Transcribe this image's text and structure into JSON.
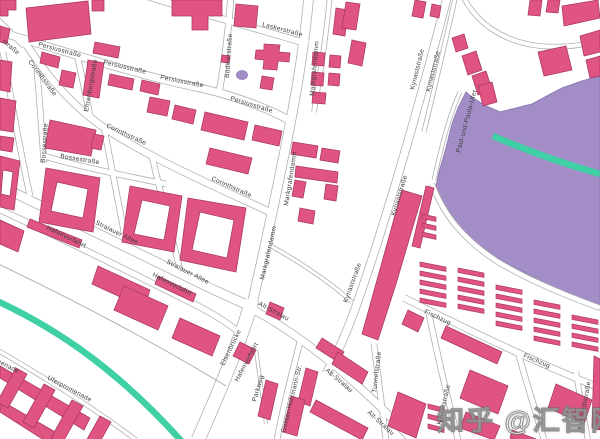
{
  "watermark": {
    "text": "知乎 @汇智网"
  },
  "map": {
    "colors": {
      "building_fill": "#df5480",
      "building_stroke": "#ad3a67",
      "water_fill": "#a38dc6",
      "water_stroke": "#8f7bb5",
      "road_casing": "#b2b0b0",
      "road_fill": "#ffffff",
      "rail_teal": "#3fd0a5",
      "label": "#3d3d3d",
      "background": "#ffffff"
    },
    "water": "600,76 582,81 562,88 545,97 532,104 516,108 500,112 484,105 472,97 466,92 458,108 452,124 446,148 439,172 436,186 443,208 456,227 473,243 494,257 518,269 544,283 570,295 590,305 600,310",
    "pond": {
      "cx": 242,
      "cy": 75,
      "rx": 5.5,
      "ry": 4.5
    },
    "teal_lines": [
      "M 493,136 C 530,152 565,164 600,174",
      "M -5,300 C 60,330 120,372 185,445"
    ],
    "roads": [
      {
        "n": "persiusstrasse",
        "d": "M -6,30 C 60,50 140,76 200,88 C 235,96 268,108 294,123",
        "w": 7
      },
      {
        "n": "corinthstrasse",
        "d": "M 22,38 C 40,66 62,96 96,122 C 140,154 212,185 274,214",
        "w": 6.5
      },
      {
        "n": "laskerstrasse",
        "d": "M 140,-6 L 205,14 C 240,24 275,34 308,44",
        "w": 6
      },
      {
        "n": "boedikerstrasse",
        "d": "M 231,-6 C 229,28 225,60 219,93",
        "w": 5.5
      },
      {
        "n": "markgrafendamm",
        "d": "M 309,-6 C 305,40 297,90 288,135 C 279,180 268,235 252,304",
        "w": 9
      },
      {
        "n": "kynaststrasse",
        "d": "M 448,-6 C 436,40 420,100 404,155 C 390,203 372,262 354,312 C 346,334 336,356 326,374",
        "w": 7.5
      },
      {
        "n": "kynaststrasse-parallel",
        "d": "M 456,-6 C 446,40 434,90 424,132",
        "w": 3.5
      },
      {
        "n": "rail-corridor",
        "d": "M 462,-6 C 476,24 504,42 540,46 C 565,48 585,45 600,40",
        "w": 4
      },
      {
        "n": "stralauer-allee",
        "d": "M -6,183 C 60,215 140,254 212,289 L 256,309",
        "w": 8.5
      },
      {
        "n": "hafenvorfahrt",
        "d": "M -6,207 C 55,235 130,272 192,303 C 212,313 228,323 240,333",
        "w": 5.5
      },
      {
        "n": "elsenbruecke",
        "d": "M 252,300 C 241,340 220,390 198,440",
        "w": 13
      },
      {
        "n": "alt-stralau",
        "d": "M 254,310 C 292,331 332,361 372,399 C 387,413 400,427 412,440",
        "w": 7
      },
      {
        "n": "fischzug",
        "d": "M 404,298 C 455,323 520,356 600,388",
        "w": 6
      },
      {
        "n": "paul-und-paula-ufer",
        "d": "M 460,92 C 449,116 441,148 434,180",
        "w": 3
      },
      {
        "n": "shore-street",
        "d": "M 432,184 C 444,216 464,240 498,262 C 534,283 570,297 600,308",
        "w": 4.5
      },
      {
        "n": "tunnelstrasse",
        "d": "M 374,344 C 378,375 382,408 386,440",
        "w": 5
      },
      {
        "n": "krachtstrasse",
        "d": "M 428,308 C 436,352 448,398 458,440",
        "w": 5
      },
      {
        "n": "cross-street-east",
        "d": "M 518,352 C 526,382 536,412 544,440",
        "w": 5
      },
      {
        "n": "bahrfeldtstrasse",
        "d": "M 576,372 C 580,398 584,420 588,440",
        "w": 4.5
      },
      {
        "n": "uferpromenade",
        "d": "M -6,348 C 40,375 90,405 136,440",
        "w": 3.5
      },
      {
        "n": "bossestrasse-vertical",
        "d": "M 37,70 C 40,105 42,135 44,163",
        "w": 5
      },
      {
        "n": "bossestrasse",
        "d": "M 44,156 C 70,164 120,175 166,184",
        "w": 5
      },
      {
        "n": "ehrenbergstrasse",
        "d": "M 77,54 L 91,120",
        "w": 5
      },
      {
        "n": "left-edge-street",
        "d": "M 3,52 C 12,105 20,150 30,196",
        "w": 5
      },
      {
        "n": "corner-street",
        "d": "M -6,16 L 24,46",
        "w": 4.5
      },
      {
        "n": "ns-street-a",
        "d": "M 104,128 C 112,170 118,200 124,232",
        "w": 5
      },
      {
        "n": "ns-street-b",
        "d": "M 152,156 C 162,200 172,236 180,270",
        "w": 5
      },
      {
        "n": "ns-street-top",
        "d": "M 330,-6 C 327,30 321,70 314,112",
        "w": 4
      },
      {
        "n": "connector-path",
        "d": "M 264,242 C 300,262 330,282 352,302",
        "w": 3
      },
      {
        "n": "gustav-holzmann-strasse",
        "d": "M 300,342 C 290,380 282,412 277,440",
        "w": 5
      },
      {
        "n": "parkweg",
        "d": "M 256,350 C 260,380 264,405 266,424",
        "w": 2.5
      }
    ],
    "thin_lines": [
      "M -6,262 C 70,298 150,340 226,386"
    ],
    "buildings": [
      "0,0 16,0 16,10 8,10 8,16 0,16",
      "26,8 88,1 91,34 29,42",
      "92,0 104,0 104,11 92,11",
      "0,26 10,29 7,44 0,42",
      "0,60 12,62 10,92 0,90",
      "0,98 16,101 13,132 0,130",
      "0,136 14,138 12,152 0,150",
      "42,52 60,57 58,68 40,63",
      "62,70 76,73 73,88 59,85",
      "88,60 104,63 99,98 83,95",
      "95,42 120,47 118,58 93,53",
      "110,74 134,79 132,90 108,85",
      "142,80 160,84 158,95 140,91",
      "150,97 170,101 167,116 147,112",
      "175,105 196,110 193,124 172,119",
      "205,112 248,122 244,140 201,130",
      "210,148 252,158 248,174 206,164",
      "255,125 282,131 279,146 252,140",
      "172,0 222,0 222,16 208,16 208,30 192,30 192,16 172,16",
      "236,4 258,6 256,28 234,26",
      "222,55 230,56 229,63 221,62",
      "264,44 280,45 279,52 290,53 289,62 278,61 277,70 263,69 264,60 255,59 256,50 264,50",
      "262,76 274,78 272,90 260,88",
      "313,52 325,53 324,66 312,65",
      "330,55 341,56 340,68 329,67",
      "312,72 324,73 323,86 311,85",
      "329,73 340,74 339,86 328,85",
      "313,92 326,93 325,104 312,103",
      "336,8 348,10 345,36 333,34",
      "346,2 360,4 356,30 342,28",
      "352,40 366,43 362,66 348,63",
      "415,0 426,2 423,18 412,16",
      "432,4 441,6 439,18 430,16",
      "452,38 464,34 468,48 456,52",
      "462,56 476,51 482,70 468,75",
      "472,76 486,71 492,90 478,95",
      "478,86 492,82 497,102 483,106",
      "538,52 566,46 572,70 544,76",
      "580,36 600,30 600,52 584,56",
      "586,60 600,56 600,76 590,78",
      "530,0 542,0 540,16 528,15",
      "548,0 560,0 558,13 546,12",
      "562,6 598,0 600,18 564,26",
      "293,142 318,146 316,158 291,154",
      "322,148 340,151 338,163 320,160",
      "296,166 338,172 337,183 295,177",
      "295,180 306,182 303,198 292,196",
      "326,184 338,186 336,201 324,199",
      "300,208 315,211 313,224 298,221",
      "402,190 422,196 396,284 378,340 362,334 382,262",
      "426,186 434,188 420,248 412,246",
      "0,156 20,161 14,210 0,207",
      "46,168 100,178 93,232 39,222",
      "50,120 96,130 91,156 45,148",
      "94,134 104,136 101,150 91,148",
      "130,186 182,196 174,252 122,242",
      "188,198 246,208 236,272 180,260",
      "0,220 24,231 18,252 0,244",
      "30,219 82,240 79,248 27,227",
      "98,266 150,290 144,308 92,284",
      "158,276 196,294 193,302 155,284",
      "124,286 168,306 158,330 114,310",
      "180,318 220,336 212,356 172,338",
      "240,342 256,350 249,364 233,356",
      "270,302 284,308 280,320 266,314",
      "0,366 90,418 84,430 0,378",
      "0,400 64,437 58,449 0,412",
      "16,368 27,374 8,408 -3,402",
      "44,384 55,390 34,428 23,422",
      "72,400 83,406 62,444 51,438",
      "100,416 111,422 92,456 81,450",
      "322,338 344,352 338,362 316,348",
      "338,352 368,372 362,384 332,364",
      "306,368 318,372 310,406 298,402",
      "266,380 278,384 270,420 258,416",
      "291,396 305,400 297,436 283,432",
      "316,400 368,428 362,440 310,412",
      "398,392 426,404 416,438 388,426",
      "408,310 424,318 418,332 402,324",
      "446,326 502,352 497,364 441,338",
      "470,370 508,386 498,414 460,398",
      "466,412 500,426 494,440 460,428",
      "556,384 592,400 584,424 548,408",
      "594,356 600,359 600,430 592,428",
      "512,430 536,439 534,446 510,438"
    ],
    "courtyards": [
      "3,170 13,172 10,196 1,194",
      "57,182 88,189 83,218 51,211",
      "142,200 170,206 164,240 134,234",
      "200,212 234,220 227,258 192,250"
    ],
    "combs": [
      {
        "x": 422,
        "y": 214,
        "n": 3,
        "w": 14,
        "dy": 9,
        "t": 3
      },
      {
        "x": 420,
        "y": 262,
        "n": 5,
        "w": 26,
        "dy": 9,
        "t": 5
      },
      {
        "x": 458,
        "y": 268,
        "n": 5,
        "w": 26,
        "dy": 9,
        "t": 5
      },
      {
        "x": 496,
        "y": 285,
        "n": 5,
        "w": 26,
        "dy": 9,
        "t": 5
      },
      {
        "x": 534,
        "y": 300,
        "n": 5,
        "w": 26,
        "dy": 9,
        "t": 5
      },
      {
        "x": 572,
        "y": 315,
        "n": 4,
        "w": 26,
        "dy": 9,
        "t": 5
      },
      {
        "x": 428,
        "y": 404,
        "n": 3,
        "w": 16,
        "dy": 10,
        "t": 4
      }
    ],
    "labels": [
      {
        "t": "Persiusstraße",
        "x": 38,
        "y": 46,
        "r": 15
      },
      {
        "t": "Persiusstraße",
        "x": 103,
        "y": 64,
        "r": 13
      },
      {
        "t": "Persiusstraße",
        "x": 160,
        "y": 79,
        "r": 11
      },
      {
        "t": "Persiusstraße",
        "x": 230,
        "y": 100,
        "r": 17
      },
      {
        "t": "Corinthstraße",
        "x": 28,
        "y": 62,
        "r": 53
      },
      {
        "t": "Corinthstraße",
        "x": 106,
        "y": 127,
        "r": 25
      },
      {
        "t": "Corinthstraße",
        "x": 211,
        "y": 180,
        "r": 24
      },
      {
        "t": "Laskerstraße",
        "x": 262,
        "y": 26,
        "r": 15
      },
      {
        "t": "Bödikerstraße",
        "x": 229,
        "y": 78,
        "r": -86
      },
      {
        "t": "Markgrafendamm",
        "x": 314,
        "y": 96,
        "r": -85
      },
      {
        "t": "Markgrafendamm",
        "x": 288,
        "y": 206,
        "r": -81
      },
      {
        "t": "Markgrafendamm",
        "x": 264,
        "y": 280,
        "r": -77
      },
      {
        "t": "Kynaststraße",
        "x": 414,
        "y": 90,
        "r": -76
      },
      {
        "t": "Kynaststraße",
        "x": 430,
        "y": 92,
        "r": -76
      },
      {
        "t": "Kynaststraße",
        "x": 395,
        "y": 216,
        "r": -73
      },
      {
        "t": "Kynaststraße",
        "x": 347,
        "y": 303,
        "r": -70
      },
      {
        "t": "Stralauer Allee",
        "x": 95,
        "y": 224,
        "r": 26
      },
      {
        "t": "Stralauer Allee",
        "x": 166,
        "y": 263,
        "r": 27
      },
      {
        "t": "Hafenvorfahrt",
        "x": 46,
        "y": 229,
        "r": 26
      },
      {
        "t": "Hafenvorfahrt",
        "x": 152,
        "y": 276,
        "r": 27
      },
      {
        "t": "Hafenvorfahrt",
        "x": 238,
        "y": 382,
        "r": -62
      },
      {
        "t": "Elsenbrücke",
        "x": 224,
        "y": 366,
        "r": -64
      },
      {
        "t": "Alt-Stralau",
        "x": 258,
        "y": 305,
        "r": 28
      },
      {
        "t": "Alt-Stralau",
        "x": 325,
        "y": 371,
        "r": 40
      },
      {
        "t": "Alt-Stralau",
        "x": 367,
        "y": 413,
        "r": 42
      },
      {
        "t": "Fischzug",
        "x": 424,
        "y": 313,
        "r": 25
      },
      {
        "t": "Fischzug",
        "x": 523,
        "y": 357,
        "r": 23
      },
      {
        "t": "Paul-und-Paula-Ufer",
        "x": 460,
        "y": 153,
        "r": -75
      },
      {
        "t": "Uferpromenade",
        "x": -26,
        "y": 351,
        "r": 27
      },
      {
        "t": "Uferpromenade",
        "x": 47,
        "y": 379,
        "r": 28
      },
      {
        "t": "Bossestraße",
        "x": 45,
        "y": 163,
        "r": -86
      },
      {
        "t": "Bossestraße",
        "x": 60,
        "y": 158,
        "r": 9
      },
      {
        "t": "Ehrenbergstraße",
        "x": 88,
        "y": 112,
        "r": -80
      },
      {
        "t": "Tunnelstraße",
        "x": 376,
        "y": 393,
        "r": -83
      },
      {
        "t": "Krachtstraße",
        "x": 441,
        "y": 425,
        "r": -77
      },
      {
        "t": "Bahrfeldtstraße",
        "x": 582,
        "y": 430,
        "r": -80
      },
      {
        "t": "Gustav-Holzmann-Str.",
        "x": 285,
        "y": 433,
        "r": -76
      },
      {
        "t": "Parkweg",
        "x": 256,
        "y": 402,
        "r": -74
      },
      {
        "t": "straße",
        "x": 2,
        "y": 42,
        "r": 40
      }
    ]
  }
}
